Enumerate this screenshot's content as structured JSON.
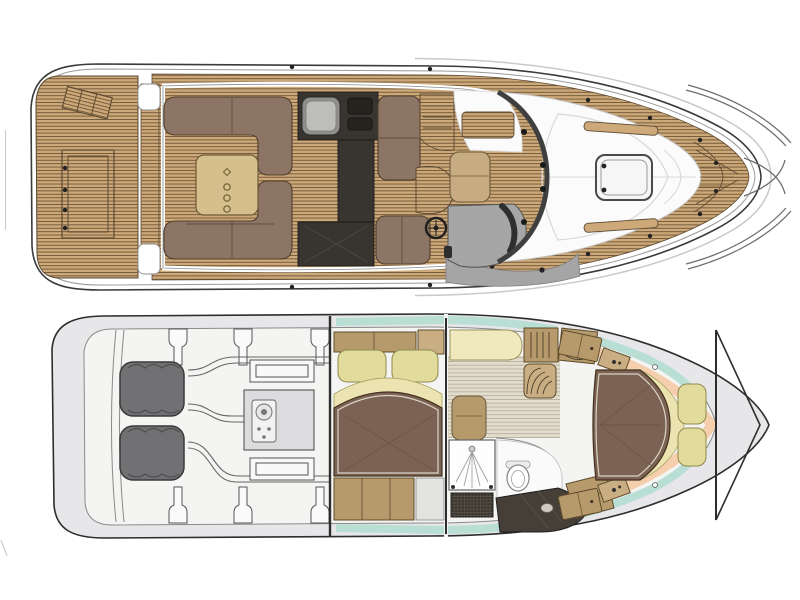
{
  "page": {
    "background": "#ffffff",
    "description": "Motor yacht floor plan, two stacked deck views, bow pointing right, no visible text labels"
  },
  "palette": {
    "background": "#ffffff",
    "outline_dark": "#3b3b3b",
    "shadow_line": "#c9c9c9",
    "rub_rail": "#9a9a9a",
    "teak_base": "#cda878",
    "teak_line": "#6e5639",
    "teak_edge": "#5c4a33",
    "gunwale_line": "#8c8c8c",
    "sofa_brown": "#8d7566",
    "sofa_edge": "#52402f",
    "table_tan": "#d5bf8c",
    "table_edge": "#6f5b36",
    "dark_unit": "#38342f",
    "sink_outer": "#8f8f8d",
    "sink_inner": "#bdbdbb",
    "seat_tan": "#c7ac82",
    "console_gray": "#a6a6a6",
    "dashboard_dark": "#2e2e2e",
    "windshield_dark": "#3f3f3f",
    "cabin_white": "#fbfbfb",
    "seam_gray": "#d9d9d9",
    "hatch_edge": "#4a4a4a",
    "rail_gray": "#6e6e6e",
    "walkway_gray": "#a5a5a5",
    "cleat_dark": "#222222",
    "hull_lower_fill": "#e7e7e9",
    "hull_lower_edge": "#2d2d2d",
    "interior_fill": "#f4f4f2",
    "interior_edge": "#8a8a8a",
    "engine_fill": "#717174",
    "engine_edge": "#3a3a3a",
    "machinery_line": "#666666",
    "genset_fill": "#dcdcde",
    "bed_brown": "#7b6252",
    "bed_edge": "#41311f",
    "bed_seam": "#6a5546",
    "pillow_cream": "#e1dc9b",
    "pillow_edge": "#8f8a4e",
    "blanket_cream": "#ebe4b0",
    "blanket_edge": "#a59f62",
    "cabinet_tan": "#b69a6c",
    "cabinet_tan_light": "#c8ae82",
    "cabinet_edge": "#5f4c2c",
    "window_teal": "#b9ded4",
    "liner_peach": "#f4cead",
    "board_base": "#e2dccd",
    "board_line": "#b3ab99",
    "counter_dark": "#453f37",
    "grate_dark": "#3a352e",
    "fixture_white": "#fdfdfd",
    "fixture_edge": "#888888",
    "bulkhead_dark": "#2d2d2d"
  },
  "views": {
    "main_deck": {
      "label": "Main deck and exterior plan",
      "areas": [
        {
          "name": "swim-platform",
          "features": "teak planking, boarding ladder, transom hatch, side steps"
        },
        {
          "name": "cockpit-saloon",
          "features": "aft U-sofa, forward L-sofa, cocktail table with cup holders, galley unit with sink and grill, side bench seats, companionway steps"
        },
        {
          "name": "helm-station",
          "features": "helm seat, steering wheel, gray console with dark dashboard, curved windshield"
        },
        {
          "name": "foredeck",
          "features": "white cabin top sunpad, deck hatch with hinges, teak grab rails, teak side decks, bow pulpit rails, cleats"
        }
      ]
    },
    "lower_deck": {
      "label": "Lower deck accommodation plan",
      "areas": [
        {
          "name": "engine-room",
          "features": "twin engines, generator console, structural stringers, exhaust and shaft runs"
        },
        {
          "name": "mid-cabin",
          "features": "athwartships double berth, two pillows, folded blanket, side lockers"
        },
        {
          "name": "saloon-corridor",
          "features": "cream settee, louvered lockers, curved companionway stairs, plank flooring, upholstered seat"
        },
        {
          "name": "head",
          "features": "shower with spray and teak grate, toilet, dark vanity counter with sink, angled locker"
        },
        {
          "name": "forward-cabin",
          "features": "island double berth, crescent blanket, two pillows, angled wardrobes, teal hull windows, peach hull liner, V bulkhead"
        }
      ]
    }
  }
}
